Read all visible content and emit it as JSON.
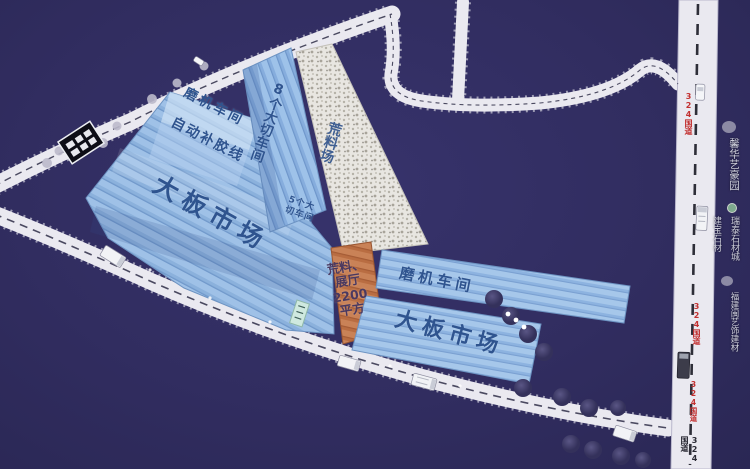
{
  "map": {
    "title": "石材园区平面图",
    "labels": {
      "grinding_left": "磨机车间",
      "glue_line": "自动补胶线",
      "slab_market_left": "大板市场",
      "eight_cut": "8个大切车间",
      "five_cut_l1": "5个大",
      "five_cut_l2": "切车间",
      "raw_yard": "荒料场",
      "hall_l1": "荒料、",
      "hall_l2": "展厅",
      "hall_l3": "2200",
      "hall_l4": "平方",
      "grinding_right": "磨机车间",
      "slab_market_bottom": "大板市场"
    },
    "highway": {
      "label_top": "324国道",
      "label_mid": "324国道",
      "label_lower": "324国道",
      "label_bottom": "324国道"
    },
    "signs": {
      "right_top": "馨华艺豪园",
      "right_a": "建宝石材",
      "right_b": "瑞泰石材城",
      "right_c": "福建闽艺饰建材"
    },
    "colors": {
      "background": "#312d60",
      "road": "#eae9f0",
      "roof_blue": "#9cbfe6",
      "roof_blue_dark": "#7fa6d4",
      "roof_orange": "#c9815a",
      "raw_yard": "#e7e5e0",
      "highway_label": "#c23030",
      "building_label": "#2f548f",
      "tree": "#3c3963",
      "sign_text": "#cdced9"
    }
  }
}
